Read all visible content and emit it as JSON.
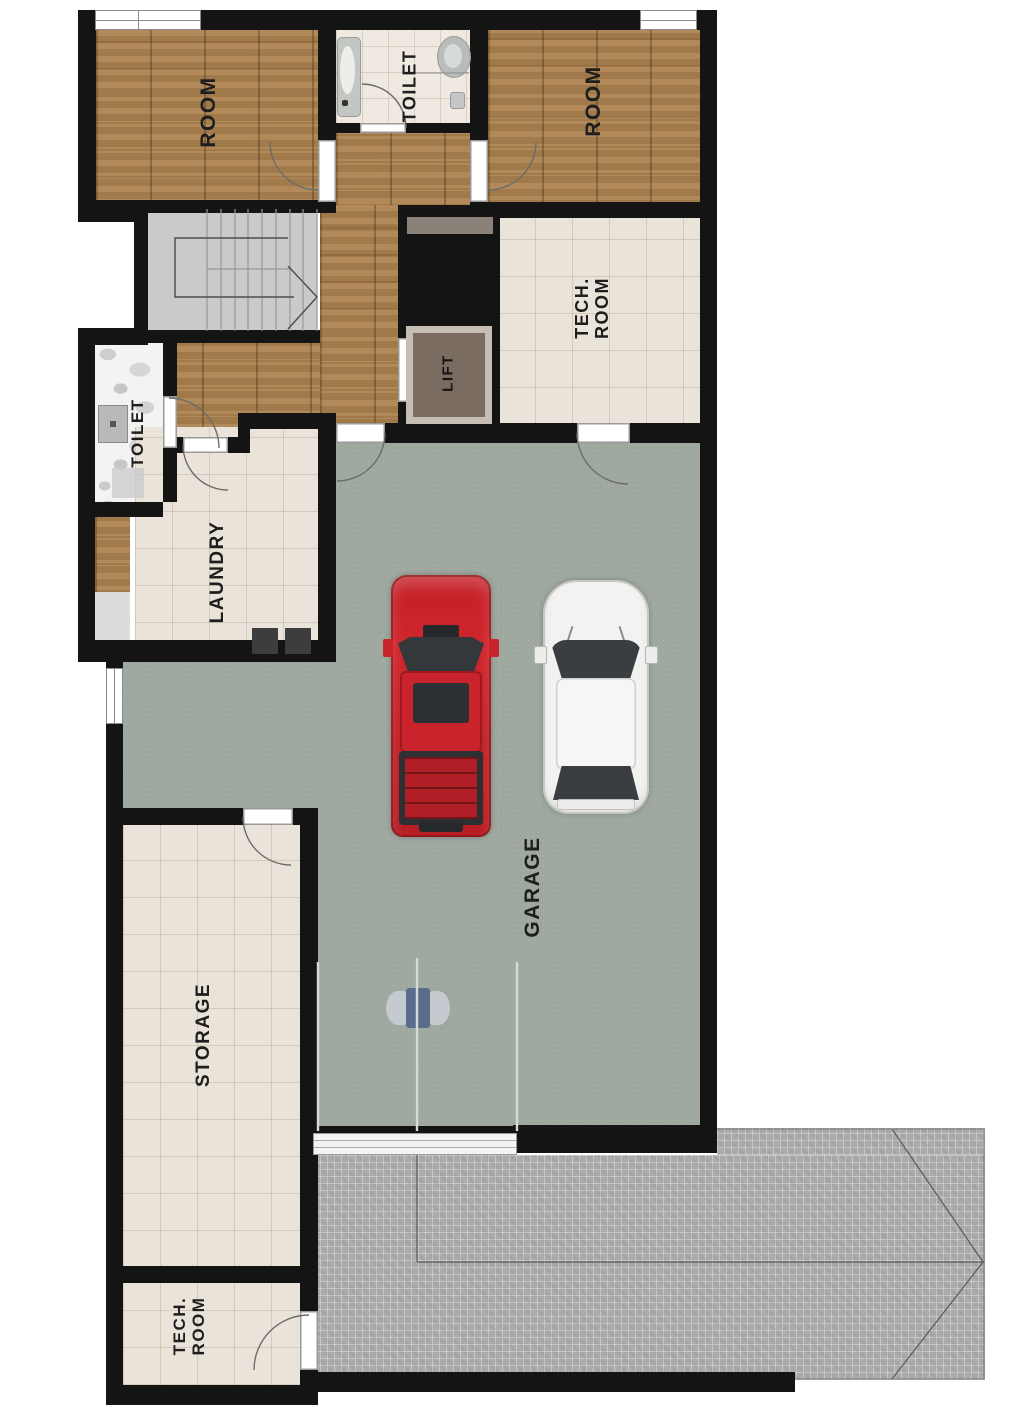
{
  "title": "Basement / garage level floor plan",
  "rooms": {
    "room_top_left": {
      "label": "ROOM"
    },
    "toilet_top": {
      "label": "TOILET"
    },
    "room_top_right": {
      "label": "ROOM"
    },
    "tech_room_upper": {
      "line1": "TECH.",
      "line2": "ROOM"
    },
    "lift": {
      "label": "LIFT"
    },
    "toilet_left": {
      "label": "TOILET"
    },
    "laundry": {
      "label": "LAUNDRY"
    },
    "garage": {
      "label": "GARAGE"
    },
    "storage": {
      "label": "STORAGE"
    },
    "tech_room_lower": {
      "line1": "TECH.",
      "line2": "ROOM"
    }
  },
  "objects": {
    "red_vehicle": "red pickup truck (top view)",
    "white_vehicle": "white SUV (top view)",
    "garage_door": "sectional garage door with ceiling opener",
    "staircase": "U-shaped staircase with direction arrow",
    "driveway": "paved driveway with slope arrow"
  },
  "colors": {
    "wall": "#141414",
    "wood_floor": "#a9804f",
    "tile_floor": "#eae3d9",
    "toilet_tile": "#efe9e1",
    "marble": "#f3f3f3",
    "garage_floor": "#9ea89e",
    "stair": "#cacaca",
    "lift_floor": "#7b6c62",
    "niche": "#8a8178",
    "paver": "#ababab",
    "car_red": "#c9242b",
    "car_white": "#f3f3f2",
    "glass_dark": "#383c3f",
    "opener_blue": "#5b6b8c"
  }
}
